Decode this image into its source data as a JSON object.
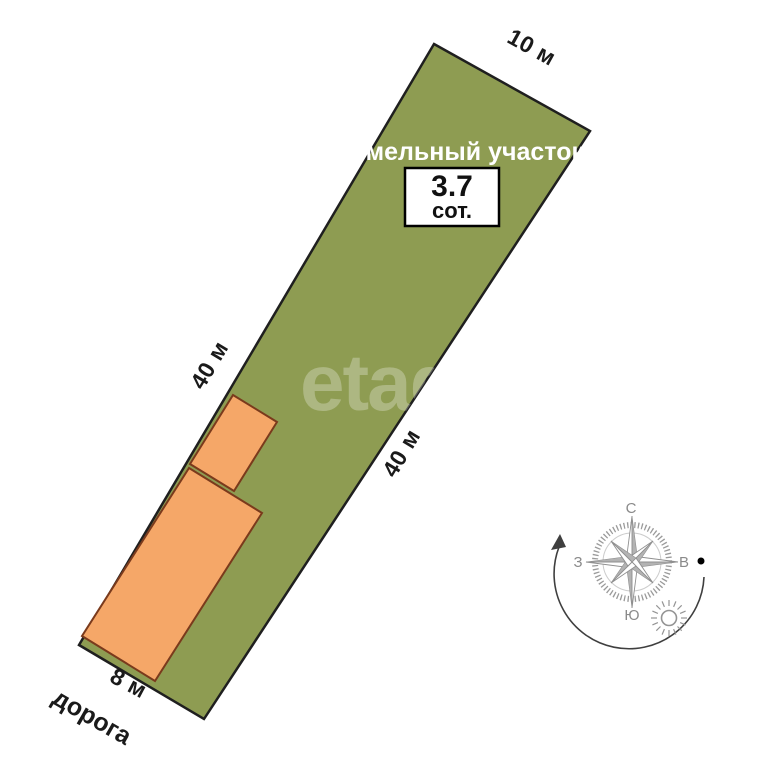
{
  "plot": {
    "label": "земельный участок",
    "area_value": "3.7",
    "area_unit": "сот.",
    "side_top": "10 м",
    "side_left": "40 м",
    "side_right": "40 м",
    "side_bottom": "8 м",
    "road_label": "дорога"
  },
  "colors": {
    "plot_fill": "#8E9C52",
    "plot_border": "#1F1F1F",
    "building_fill": "#F5A768",
    "building_border": "#7A3A1C",
    "dimension_text": "#1A1A1A",
    "plot_label_text": "#FFFFFF",
    "compass_gray": "#8A8A8A"
  },
  "compass": {
    "north": "С",
    "south": "Ю",
    "west": "З",
    "east": "В"
  },
  "watermark": "etagi"
}
